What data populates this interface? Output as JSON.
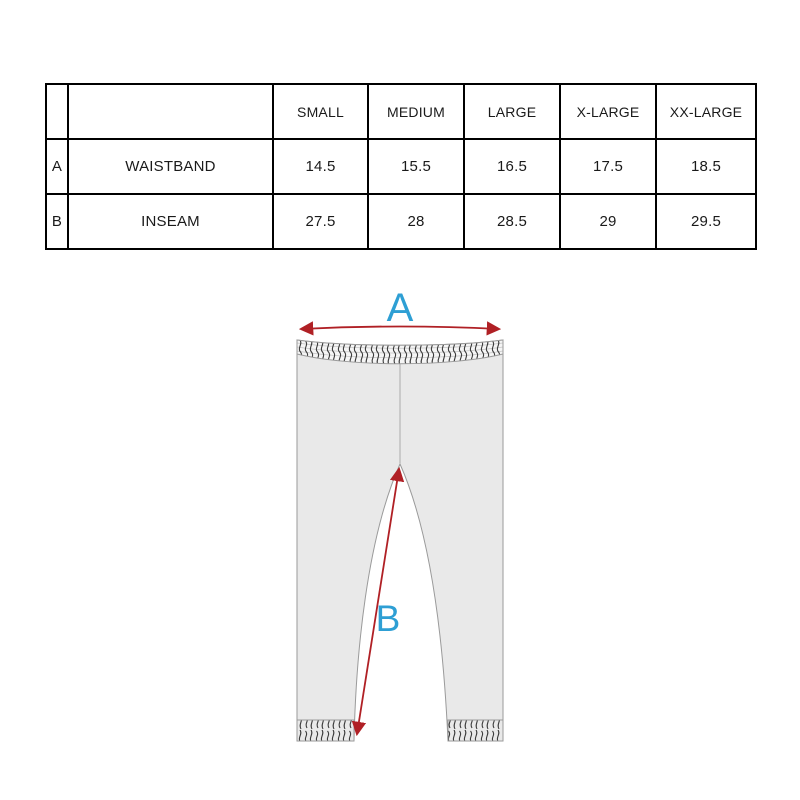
{
  "table": {
    "headers": [
      "",
      "",
      "SMALL",
      "MEDIUM",
      "LARGE",
      "X-LARGE",
      "XX-LARGE"
    ],
    "rows": [
      {
        "key": "A",
        "measurement": "WAISTBAND",
        "values": [
          "14.5",
          "15.5",
          "16.5",
          "17.5",
          "18.5"
        ]
      },
      {
        "key": "B",
        "measurement": "INSEAM",
        "values": [
          "27.5",
          "28",
          "28.5",
          "29",
          "29.5"
        ]
      }
    ]
  },
  "diagram": {
    "garment": "leggings",
    "measure_a_label": "A",
    "measure_b_label": "B",
    "colors": {
      "measure_label": "#2e9fd4",
      "arrow": "#b02025",
      "garment_fill": "#e9e9e9",
      "garment_outline": "#9a9a9a",
      "band_fill": "#f5f5f5",
      "texture_ink": "#3a3a3a"
    }
  },
  "chart_data": {
    "type": "table",
    "title": "Leggings size chart",
    "columns": [
      "SMALL",
      "MEDIUM",
      "LARGE",
      "X-LARGE",
      "XX-LARGE"
    ],
    "rows": [
      {
        "id": "A",
        "label": "WAISTBAND",
        "values": [
          14.5,
          15.5,
          16.5,
          17.5,
          18.5
        ]
      },
      {
        "id": "B",
        "label": "INSEAM",
        "values": [
          27.5,
          28,
          28.5,
          29,
          29.5
        ]
      }
    ]
  }
}
